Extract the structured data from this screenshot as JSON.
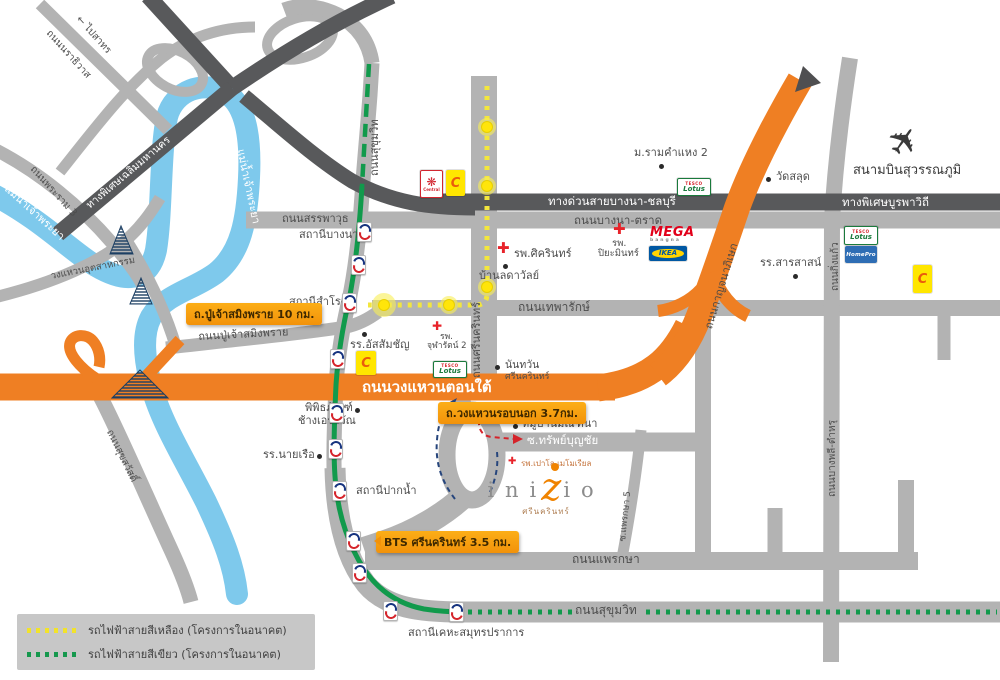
{
  "colors": {
    "road_light": "#b3b3b3",
    "road_dark": "#58595b",
    "highway_orange": "#ef7f23",
    "river_blue": "#7ec9ec",
    "green_line": "#119a4c",
    "yellow_line": "#f3e63d",
    "badge_yellow": "#f9a01b",
    "logo_orange": "#f08300"
  },
  "icons": {
    "plane": "✈",
    "cross": "✚",
    "star": "❋",
    "arrow_left": "←"
  },
  "roads": {
    "narathiwat": "ถนนนราธิวาส",
    "to_sathorn": "← ไปสาทร",
    "chalerm_expwy": "ทางพิเศษเฉลิมมหานคร",
    "rama3": "ถนนพระราม 3",
    "chao_phraya": "แม่น้ำเจ้าพระยา",
    "industrial_ring": "วงแหวนอุตสาหกรรม",
    "bangna_expwy": "ทางด่วนบางนา",
    "sukhumvit": "ถนนสุขุมวิท",
    "sanphawut": "ถนนสรรพาวุธ",
    "bangna_chonburi_expwy": "ทางด่วนสายบางนา-ชลบุรี",
    "bangna_trad": "ถนนบางนา-ตราด",
    "burapha_expwy": "ทางพิเศษบูรพาวิถี",
    "srinakarin": "ถนนศรีนครินทร์",
    "theparak": "ถนนเทพารักษ์",
    "pujao": "ถนนปู่เจ้าสมิงพราย",
    "ring_south": "ถนนวงแหวนตอนใต้",
    "kanchanaphisek": "ถนนกาญจนาภิเษก",
    "kingkaew": "ถนนกิ่งแก้ว",
    "bangphli_tamru": "ถนนบางพลี-ตำหรุ",
    "suksawat": "ถนนสุขสวัสดิ์",
    "sap_bunchai": "ซ.ทรัพย์บุญชัย",
    "praksa": "ถนนแพรกษา",
    "praksa5": "ซ.แพรกษา 5"
  },
  "stations": {
    "bangna": "สถานีบางนา",
    "samrong": "สถานีสำโรง",
    "paknam": "สถานีปากน้ำ",
    "kheha": "สถานีเคหะสมุทรปราการ"
  },
  "places": {
    "ram2": "ม.รามคำแหง 2",
    "wat_salud": "วัดสลุด",
    "airport": "สนามบินสุวรรณภูมิ",
    "sikarin": "รพ.ศิครินทร์",
    "piyamin_line1": "รพ.",
    "piyamin_line2": "ปิยะมินทร์",
    "ladawan": "บ้านลดาวัลย์",
    "sarasas": "รร.สารสาสน์",
    "assumption": "รร.อัสสัมชัญ",
    "chularat_line1": "รพ.",
    "chularat_line2": "จุฬารัตน์ 2",
    "nantawan_line1": "นันทวัน",
    "nantawan_line2": "ศรีนครินทร์",
    "erawan_line1": "พิพิธภัณฑ์",
    "erawan_line2": "ช้างเอราวัณ",
    "navy": "รร.นายเรือ",
    "mantana": "หมู่บ้านมัณฑนา",
    "paolo": "รพ.เปาโล เมโมเรียล"
  },
  "badges": {
    "pujao": "ถ.ปู่เจ้าสมิงพราย 10 กม.",
    "outer_ring": "ถ.วงแหวนรอบนอก 3.7กม.",
    "bts": "BTS ศรีนครินทร์ 3.5 กม."
  },
  "logos": {
    "central": "Central",
    "bigc": "C",
    "tesco": "TESCO",
    "lotus": "Lotus",
    "homepro": "HomePro",
    "mega": "MEGA",
    "mega_sub": "bangna",
    "ikea": "IKEA"
  },
  "project": {
    "pre": "ini",
    "z": "z",
    "post": "io",
    "subtitle": "ศรีนครินทร์"
  },
  "legend": {
    "yellow": "รถไฟฟ้าสายสีเหลือง (โครงการในอนาคต)",
    "green": "รถไฟฟ้าสายสีเขียว (โครงการในอนาคต)"
  }
}
